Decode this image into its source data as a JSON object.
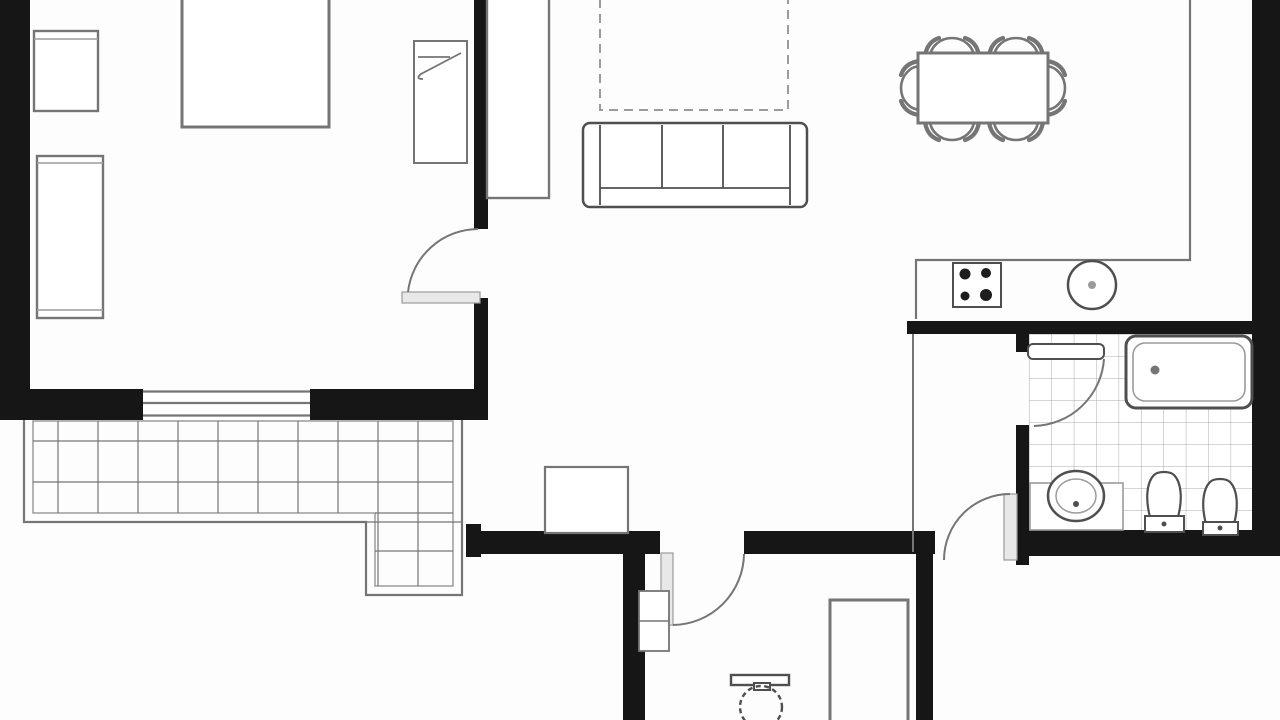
{
  "document": {
    "type": "apartment-floor-plan",
    "style": "black-and-white architectural line drawing, cropped at top and bottom edges",
    "visible_text_labels": false
  },
  "colors": {
    "background": "#fcfcfc",
    "wall": "#161616",
    "line_strong": "#4f4f4f",
    "line_mid": "#757575",
    "line_light": "#9b9b9b",
    "tile_line": "#ababab",
    "door_leaf_fill": "#e8e8e8",
    "burner_fill": "#1d1d1d"
  },
  "rooms": [
    {
      "id": "bedroom-top-left",
      "elements": [
        "double-bed-cropped",
        "nightstand",
        "wardrobe",
        "single-bed-with-pillow",
        "swing-door",
        "window-in-bottom-wall"
      ]
    },
    {
      "id": "living-room",
      "elements": [
        "tall-cabinet",
        "dashed-overhead-outline",
        "three-seat-sofa",
        "entry-cabinet"
      ]
    },
    {
      "id": "dining-area",
      "elements": [
        "rectangular-table",
        "chair-count-6"
      ]
    },
    {
      "id": "kitchen",
      "elements": [
        "l-shaped-counter",
        "cooktop-4-burners",
        "round-sink"
      ]
    },
    {
      "id": "terrace",
      "elements": [
        "l-shaped-tiled-deck",
        "double-line-border"
      ]
    },
    {
      "id": "bathroom",
      "elements": [
        "tiled-floor",
        "bathtub",
        "washbasin-on-counter",
        "toilet",
        "bidet",
        "swing-door"
      ]
    },
    {
      "id": "vestibule",
      "elements": [
        "thin-partition",
        "swing-door"
      ]
    },
    {
      "id": "wc-room",
      "elements": [
        "round-toilet-dashed",
        "shower-or-cabinet",
        "small-cabinet",
        "swing-door"
      ]
    }
  ],
  "counts": {
    "dining_chairs": 6,
    "cooktop_burners": 4
  }
}
